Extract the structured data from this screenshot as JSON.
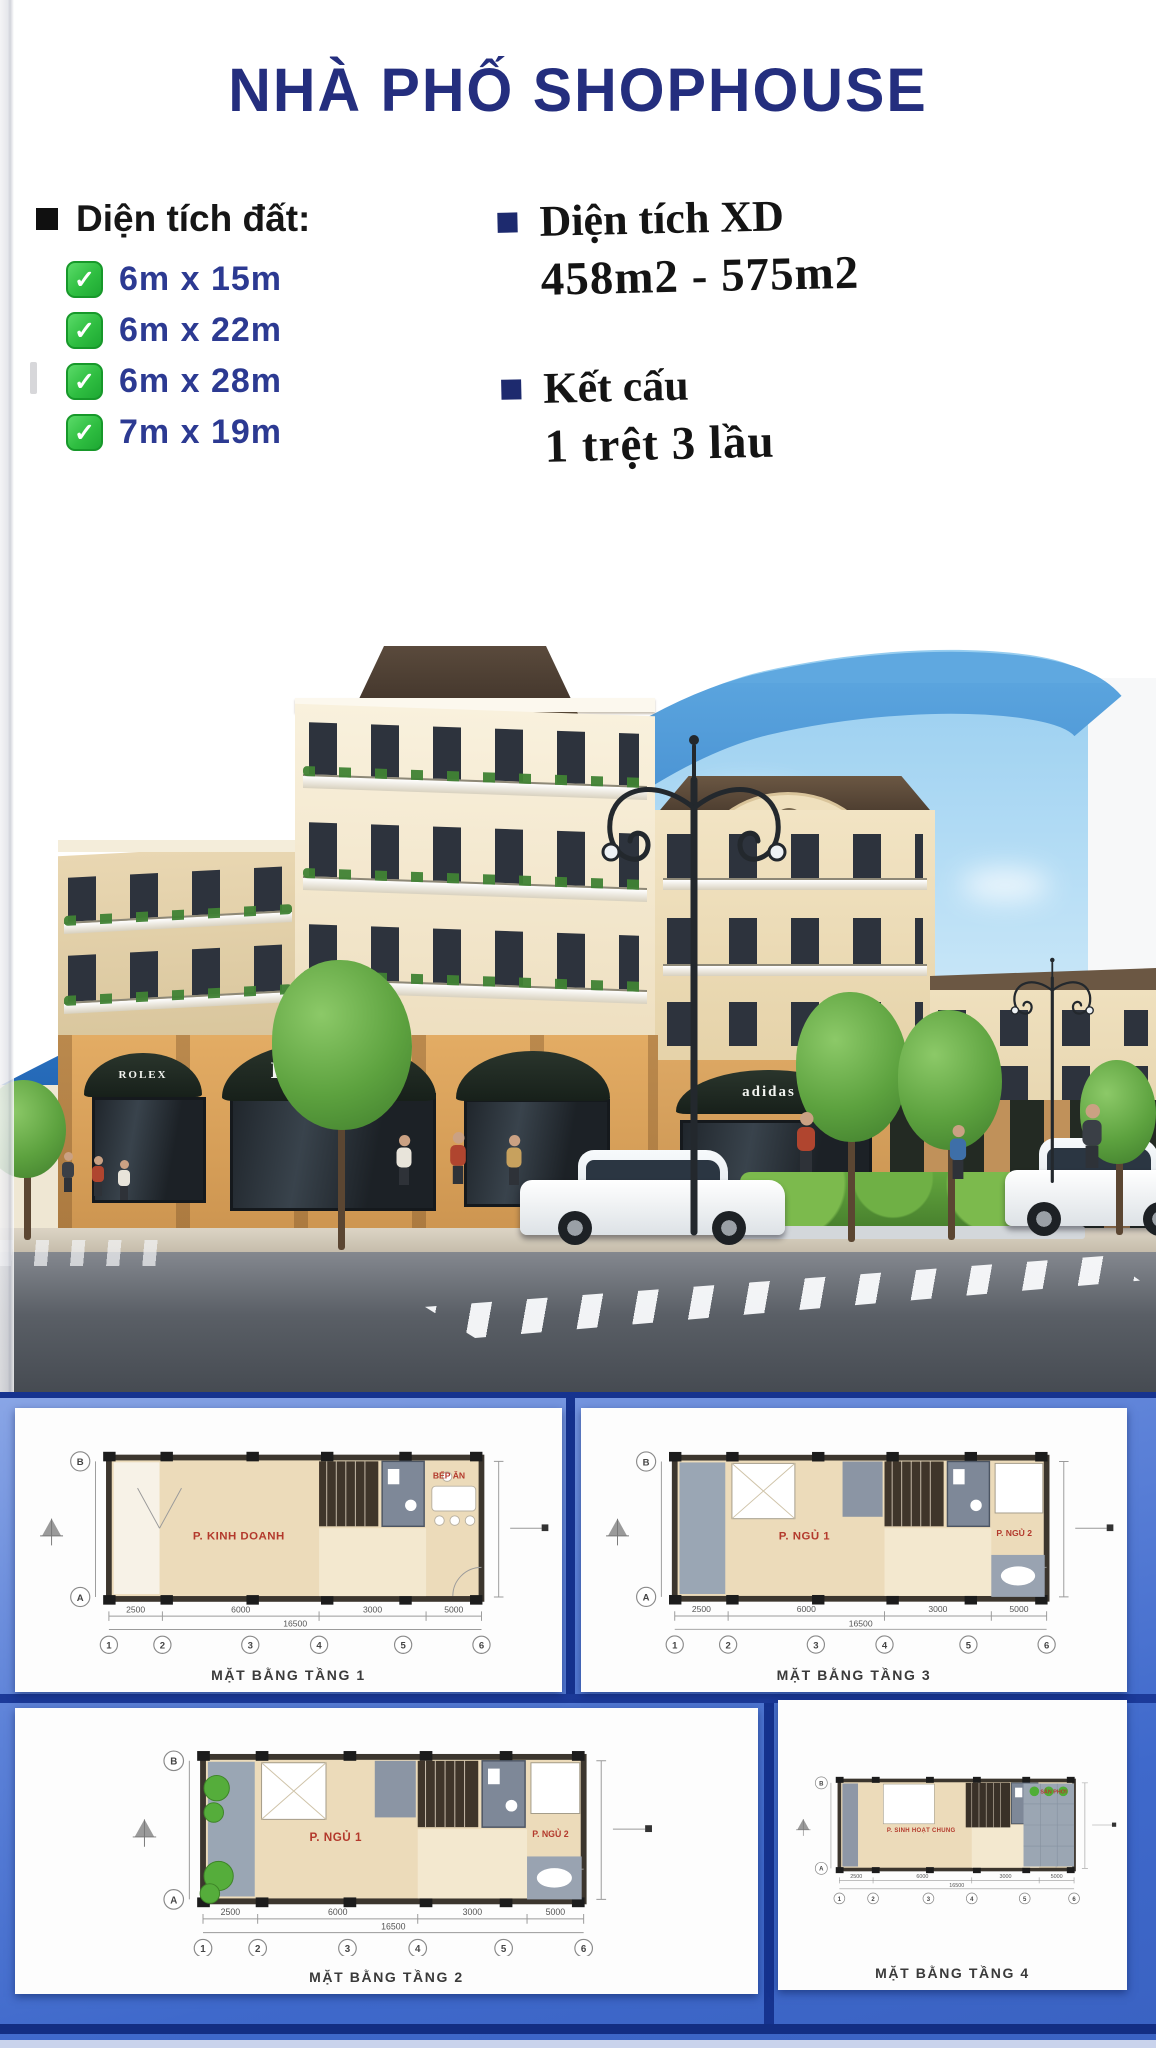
{
  "page": {
    "title": "NHÀ PHỐ SHOPHOUSE"
  },
  "specs": {
    "land": {
      "heading": "Diện tích đất:",
      "check_glyph": "✓",
      "items": [
        "6m x 15m",
        "6m x 22m",
        "6m x 28m",
        "7m x 19m"
      ]
    },
    "construction": {
      "heading": "Diện tích XD",
      "value": "458m2 - 575m2"
    },
    "structure": {
      "heading": "Kết cấu",
      "value": "1 trệt 3 lầu"
    }
  },
  "render_photo": {
    "signs": {
      "awning_left": "ROLEX",
      "awning_center": "ROLEX",
      "awning_right": "adidas"
    }
  },
  "floor_plans": {
    "grid_labels": [
      "1",
      "2",
      "3",
      "4",
      "5",
      "6"
    ],
    "row_labels": [
      "B",
      "A"
    ],
    "dims": [
      "2500",
      "6000",
      "3000",
      "5000"
    ],
    "total_dim": "16500",
    "panels": [
      {
        "caption": "MẶT BẰNG TẦNG 1",
        "variant": "t1",
        "room_main": "P. KINH DOANH",
        "room_sub": "BẾP ĂN"
      },
      {
        "caption": "MẶT BẰNG TẦNG 3",
        "variant": "t3",
        "room_main": "P. NGỦ 1",
        "room_sub": "P. NGỦ 2"
      },
      {
        "caption": "MẶT BẰNG TẦNG 2",
        "variant": "t2",
        "room_main": "P. NGỦ 1",
        "room_sub": "P. NGỦ 2"
      },
      {
        "caption": "MẶT BẰNG TẦNG 4",
        "variant": "t4",
        "room_main": "P. SINH HOẠT CHUNG",
        "room_sub": "SÂN PHƠI"
      }
    ]
  },
  "colors": {
    "title_navy": "#242e7e",
    "list_blue": "#2c3a92",
    "check_green": "#2fbe41",
    "arc_blue": "#2f86d6",
    "section_blue": "#3f69cb",
    "plan_label_red": "#b3392c"
  }
}
